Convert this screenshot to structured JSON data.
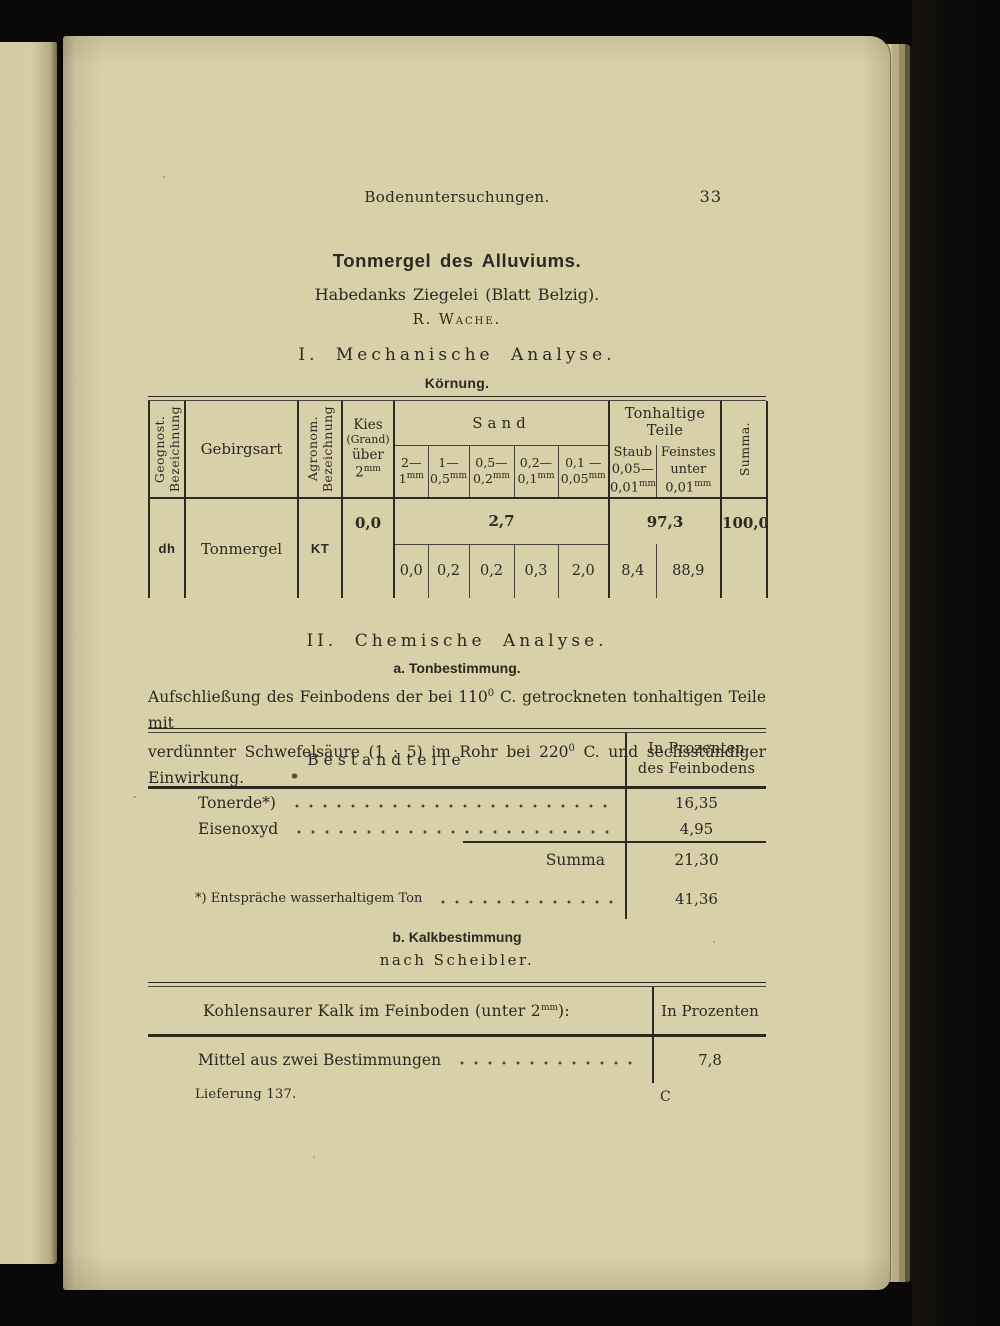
{
  "colors": {
    "paper": "#d7d0a8",
    "ink": "#2d2822",
    "cover_black": "#0a0908"
  },
  "header": {
    "running_title": "Bodenuntersuchungen.",
    "page_number": "33"
  },
  "title_block": {
    "title": "Tonmergel des Alluviums.",
    "subtitle": "Habedanks Ziegelei (Blatt Belzig).",
    "author": "R. Wache."
  },
  "mech": {
    "heading": "I. Mechanische Analyse.",
    "subheading": "Körnung.",
    "table": {
      "geognost": [
        "Geognost.",
        "Bezeichnung"
      ],
      "gebirgsart": "Gebirgsart",
      "agronom": [
        "Agronom.",
        "Bezeichnung"
      ],
      "kies": {
        "l1": "Kies",
        "l2": "(Grand)",
        "l3": "über",
        "num": "2",
        "sup": "mm"
      },
      "sand_label": "Sand",
      "sand_cols": [
        {
          "a": "2—",
          "b": "1",
          "sup": "mm"
        },
        {
          "a": "1—",
          "b": "0,5",
          "sup": "mm"
        },
        {
          "a": "0,5—",
          "b": "0,2",
          "sup": "mm"
        },
        {
          "a": "0,2—",
          "b": "0,1",
          "sup": "mm"
        },
        {
          "a": "0,1 —",
          "b": "0,05",
          "sup": "mm"
        }
      ],
      "ton_label": [
        "Tonhaltige",
        "Teile"
      ],
      "staub": {
        "a": "Staub",
        "b": "0,05—",
        "c": "0,01",
        "sup": "mm"
      },
      "feinstes": {
        "a": "Feinstes",
        "b": "unter",
        "c": "0,01",
        "sup": "mm"
      },
      "summa_label": "Summa.",
      "row": {
        "geognost": "dh",
        "gebirgsart": "Tonmergel",
        "agronom": "KT",
        "kies": "0,0",
        "sand_total": "2,7",
        "sand": [
          "0,0",
          "0,2",
          "0,2",
          "0,3",
          "2,0"
        ],
        "ton_total": "97,3",
        "ton": [
          "8,4",
          "88,9"
        ],
        "summa": "100,0"
      }
    }
  },
  "chem": {
    "heading": "II. Chemische Analyse.",
    "sub_a": "a. Tonbestimmung.",
    "para": {
      "l1_pre": "Aufschließung des Feinbodens der bei 110",
      "l1_sup": "0",
      "l1_post": " C. getrockneten tonhaltigen Teile mit",
      "l2_pre": "verdünnter Schwefelsäure (1 : 5) im Rohr bei 220",
      "l2_sup": "0",
      "l2_post": " C. und sechsstündiger Einwirkung."
    }
  },
  "best": {
    "header_left": "Bestandteile",
    "header_right": [
      "In Prozenten",
      "des Feinbodens"
    ],
    "rows": [
      {
        "label": "Tonerde*)",
        "value": "16,35"
      },
      {
        "label": "Eisenoxyd",
        "value": "4,95"
      }
    ],
    "summa_label": "Summa",
    "summa_value": "21,30",
    "footnote": {
      "label": "*) Entspräche wasserhaltigem Ton",
      "value": "41,36"
    }
  },
  "kalk": {
    "heading": "b. Kalkbestimmung",
    "subheading": "nach Scheibler.",
    "header_pre": "Kohlensaurer Kalk im Feinboden (unter 2",
    "header_sup": "mm",
    "header_post": "):",
    "header_right": "In Prozenten",
    "row_label": "Mittel aus zwei Bestimmungen",
    "row_value": "7,8"
  },
  "footer": {
    "lieferung": "Lieferung 137.",
    "signature": "C"
  }
}
